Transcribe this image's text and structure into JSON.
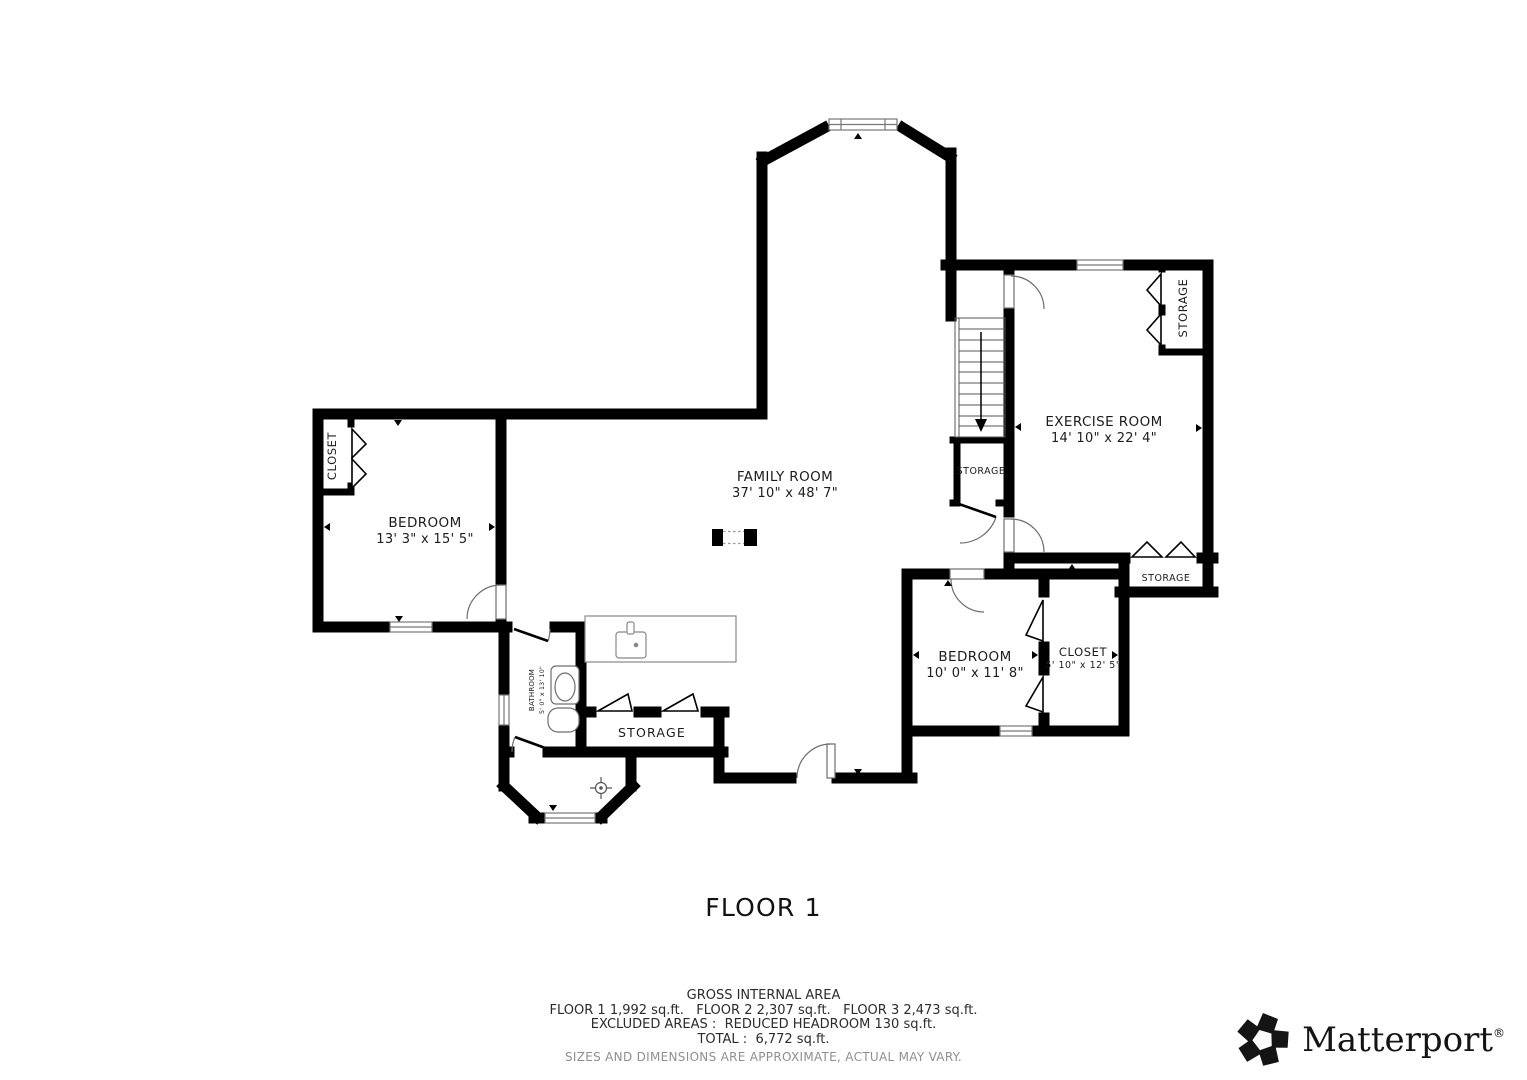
{
  "plan": {
    "title": "FLOOR 1",
    "rooms": {
      "family": {
        "name": "FAMILY ROOM",
        "dims": "37' 10\" x 48' 7\""
      },
      "bedroom_left": {
        "name": "BEDROOM",
        "dims": "13' 3\" x 15' 5\""
      },
      "exercise": {
        "name": "EXERCISE ROOM",
        "dims": "14' 10\" x 22' 4\""
      },
      "bedroom_right": {
        "name": "BEDROOM",
        "dims": "10' 0\" x 11' 8\""
      },
      "closet_right": {
        "name": "CLOSET",
        "dims": "5' 10\" x 12' 5\""
      },
      "bathroom": {
        "name": "BATHROOM",
        "dims": "5' 0\" x 13' 10\""
      },
      "closet_left": {
        "name": "CLOSET"
      },
      "storage_under_stairs": {
        "name": "STORAGE"
      },
      "storage_top_right": {
        "name": "STORAGE"
      },
      "storage_mid_right": {
        "name": "STORAGE"
      },
      "storage_hall": {
        "name": "STORAGE"
      }
    }
  },
  "footer": {
    "heading": "GROSS INTERNAL AREA",
    "floors": "FLOOR 1 1,992 sq.ft.   FLOOR 2 2,307 sq.ft.   FLOOR 3 2,473 sq.ft.",
    "excluded": "EXCLUDED AREAS :  REDUCED HEADROOM 130 sq.ft.",
    "total": "TOTAL :  6,772 sq.ft.",
    "disclaimer": "SIZES AND DIMENSIONS ARE APPROXIMATE, ACTUAL MAY VARY."
  },
  "brand": {
    "name": "Matterport",
    "mark": "®"
  },
  "colors": {
    "wall": "#000000",
    "fixture_line": "#6e6e6e",
    "text": "#1c1c1c",
    "muted_text": "#8f8f8f"
  }
}
